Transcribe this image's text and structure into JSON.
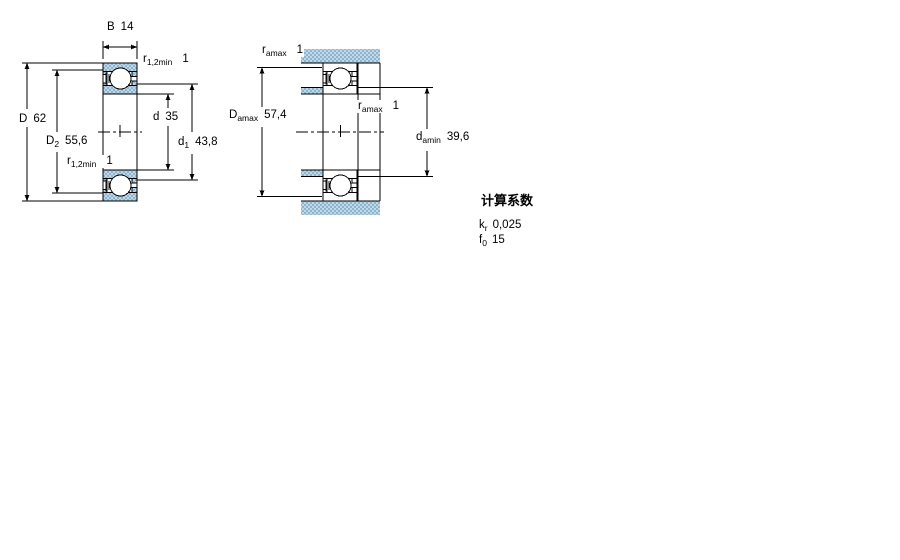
{
  "figure_left": {
    "name": "bearing-cross-section",
    "dims": {
      "B": {
        "sym": "B",
        "sub": "",
        "val": "14"
      },
      "r12_top": {
        "sym": "r",
        "sub": "1,2min",
        "val": "1"
      },
      "D": {
        "sym": "D",
        "sub": "",
        "val": "62"
      },
      "D2": {
        "sym": "D",
        "sub": "2",
        "val": "55,6"
      },
      "r12_bot": {
        "sym": "r",
        "sub": "1,2min",
        "val": "1"
      },
      "d": {
        "sym": "d",
        "sub": "",
        "val": "35"
      },
      "d1": {
        "sym": "d",
        "sub": "1",
        "val": "43,8"
      }
    }
  },
  "figure_right": {
    "name": "mounting-abutment-drawing",
    "dims": {
      "ra_top": {
        "sym": "r",
        "sub": "amax",
        "val": "1"
      },
      "Da": {
        "sym": "D",
        "sub": "amax",
        "val": "57,4"
      },
      "ra_mid": {
        "sym": "r",
        "sub": "amax",
        "val": "1"
      },
      "da": {
        "sym": "d",
        "sub": "amin",
        "val": "39,6"
      }
    }
  },
  "calculation_factors": {
    "title": "计算系数",
    "rows": [
      {
        "sym": "k",
        "sub": "r",
        "val": "0,025"
      },
      {
        "sym": "f",
        "sub": "0",
        "val": "15"
      }
    ]
  },
  "colors": {
    "hatch_light": "#bed9e8",
    "hatch_dark": "#8fb3cd",
    "line": "#000000"
  }
}
